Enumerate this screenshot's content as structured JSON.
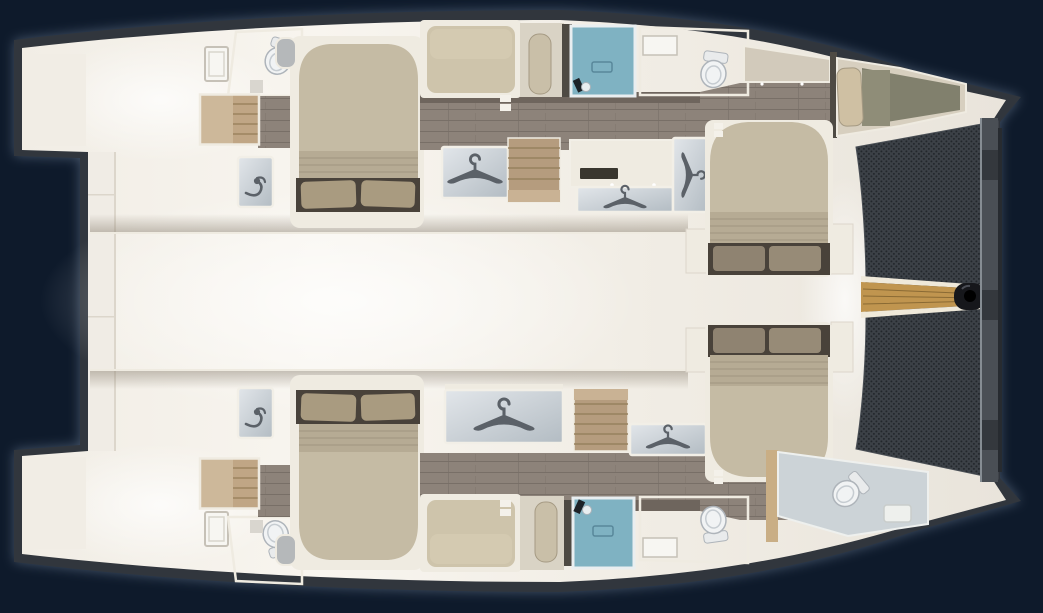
{
  "plan": {
    "vessel": "catamaran",
    "view": "top-down interior deck plan",
    "orientation": {
      "bow": "right",
      "stern": "left"
    },
    "upper_hull_rooms": [
      "aft-swim-platform",
      "aft-cabin-double-bed",
      "aft-head-toilet",
      "aft-steps",
      "vanity-sink",
      "wardrobe-hanger-locker",
      "companionway-steps",
      "single-berth",
      "settee-pad",
      "shower-stall",
      "mid-head-toilet",
      "vanity-cabinet",
      "forward-cabin-double-bed",
      "forepeak-berth"
    ],
    "lower_hull_rooms": [
      "aft-swim-platform",
      "aft-cabin-double-bed",
      "aft-head-toilet",
      "aft-steps",
      "vanity-sink",
      "wardrobe-hanger-locker",
      "companionway-steps",
      "single-berth",
      "settee-pad",
      "shower-stall",
      "mid-head-toilet",
      "forward-cabin-double-bed",
      "bow-head-toilet"
    ],
    "deck_features": [
      "cockpit",
      "salon-bridge-deck",
      "trampoline-net",
      "teak-bowsprit",
      "forward-crossbeam"
    ],
    "counts": {
      "double_beds": 4,
      "single_berths": 3,
      "toilets": 5,
      "showers": 2,
      "hanger_lockers": 5,
      "stairs": 4,
      "hatches": 2
    }
  },
  "colors": {
    "bg": "#0e1a2b",
    "glow": "#9fb2cc",
    "hull-edge": "#31363d",
    "hull-light": "#f8f5ef",
    "hull-mid": "#f1ede5",
    "hull-dim": "#e9e4db",
    "wall": "#f0ece5",
    "wall-edge": "#dcd6cb",
    "wood": "#8d837a",
    "wood-line": "#786f67",
    "wood-dark": "#6e655d",
    "frame": "#efebe1",
    "mattress": "#c5bba4",
    "rib": "#b6ab94",
    "rib-line": "#a59a83",
    "pillow": "#a99b80",
    "pillow-dark": "#8f8371",
    "pillow-dark2": "#978b77",
    "bed-shadow": "#49423a",
    "berth": "#cec4ab",
    "berth-sheen": "#d8cfb6",
    "pad-bg": "#d9d3c5",
    "pad": "#c9bfa8",
    "divider": "#4e4a43",
    "panel-1": "#e2e6ea",
    "panel-2": "#b3bcc3",
    "panel-frame": "#f2efe7",
    "glyph": "#5b6168",
    "shower": "#7fb2c2",
    "shower-frame": "#e9eef0",
    "drain": "#58879a",
    "fixture-dark": "#1d2227",
    "toilet-1": "#f1f3f4",
    "toilet-line": "#aeb4ba",
    "toilet-inner": "#c6ccd1",
    "tank": "#e9ebec",
    "bath-floor": "#ccd3d7",
    "bath-frame": "#eef0ee",
    "wedge": "#d2cabb",
    "olive": "#81806d",
    "olive-light": "#8f8d78",
    "fp-frame": "#d7cfbf",
    "fp-pillow": "#cfc0a3",
    "seat-gray": "#b5b8ba",
    "stair-light": "#cdb89a",
    "stair": "#c0a685",
    "stair-line": "#9c835f",
    "stair-mid": "#b59c7e",
    "stair-mid-line": "#97815f",
    "stair-mid-light": "#c9b294",
    "mesh": "#3c4147",
    "mesh-dot": "#23272c",
    "beam": "#4a4f55",
    "beam-dark": "#34383d",
    "beam-edge": "#868d93",
    "beam-shadow": "#272b30",
    "teak": "#c0954f",
    "teak-line": "#8a6a34",
    "teak-rim": "#efe9da",
    "roller": "#16171b",
    "shade": "#8c8273",
    "shelf": "#d9d6cf",
    "partition-tan": "#c9ae85",
    "white-mark": "#f4f1ea",
    "slot": "#39362e",
    "tray": "#eef0ed",
    "tray-line": "#c9cdcb",
    "window-fill": "#f7f6f2",
    "window-frame": "#c6c1b7",
    "window-line": "#d9d5cc"
  }
}
